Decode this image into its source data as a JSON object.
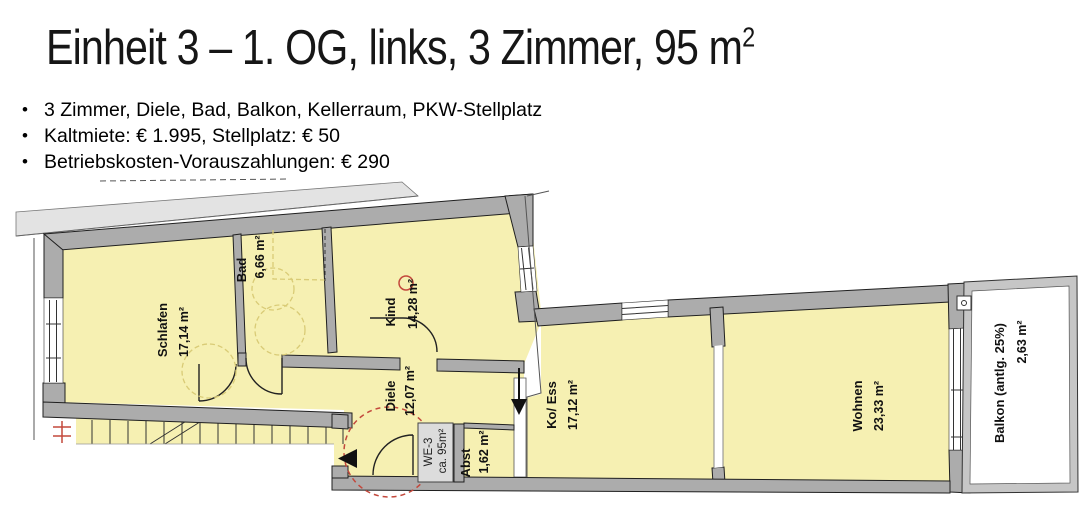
{
  "title": {
    "main": "Einheit 3 – 1. OG, links, 3 Zimmer, 95 m",
    "sup": "2"
  },
  "bullets": [
    "3 Zimmer, Diele, Bad, Balkon, Kellerraum, PKW-Stellplatz",
    "Kaltmiete: € 1.995, Stellplatz: € 50",
    "Betriebskosten-Vorauszahlungen: € 290"
  ],
  "floorplan": {
    "rooms": [
      {
        "name": "Schlafen",
        "area": "17,14 m²"
      },
      {
        "name": "Bad",
        "area": "6,66 m²"
      },
      {
        "name": "Kind",
        "area": "14,28 m²"
      },
      {
        "name": "Diele",
        "area": "12,07 m²"
      },
      {
        "name": "Ko/ Ess",
        "area": "17,12 m²"
      },
      {
        "name": "Wohnen",
        "area": "23,33 m²"
      },
      {
        "name": "Balkon (antlg. 25%)",
        "area": "2,63 m²"
      },
      {
        "name": "Abst",
        "area": "1,62 m²"
      }
    ],
    "unit_label": {
      "line1": "WE-3",
      "line2": "ca. 95m²"
    },
    "colors": {
      "room_fill": "#F6F0B2",
      "wall": "#ACACAC",
      "roof_band": "#E3E3E3",
      "balcony_rail": "#C6C6C6",
      "furniture_dash": "#D9CB76",
      "accent_red": "#C3483C"
    }
  }
}
